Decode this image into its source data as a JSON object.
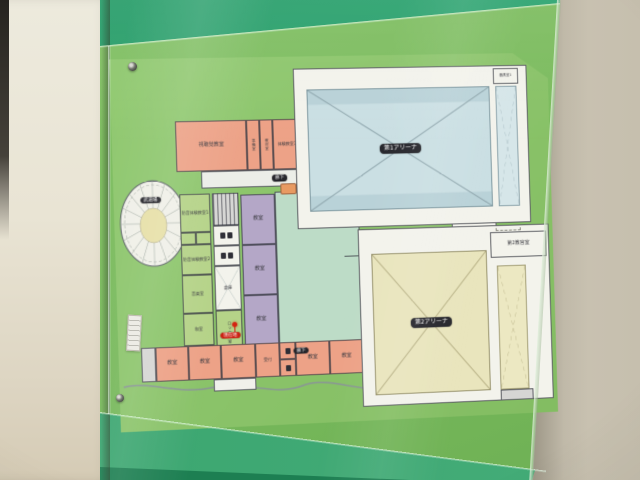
{
  "floor_plan": {
    "arena1": {
      "label": "第1アリーナ",
      "equipment_room": "器具室1"
    },
    "arena2": {
      "label": "第2アリーナ",
      "instructor_room": "第2教官室"
    },
    "round_hall": {
      "label": "武道場"
    },
    "upper_rooms": {
      "av_room": "視聴覚教室",
      "prep_room": "準備室",
      "material_room": "教材室",
      "experience_room_3": "体験教室3"
    },
    "west_rooms": {
      "soundproof_1": "防音体験教室1",
      "soundproof_2": "防音体験教室2",
      "music_room": "音楽室",
      "japanese_room": "和室"
    },
    "core_rooms": {
      "stairs": "階段",
      "storage": "倉庫",
      "locker_room": "ロッカー室"
    },
    "entrance": {
      "reception": "受付",
      "you_are_here": "現在地"
    },
    "labels": {
      "classroom": "教室",
      "corridor": "廊下"
    }
  },
  "colors": {
    "sign_green": "#7cbc5f",
    "sign_top_band": "#2b9e6b",
    "map_grass": "#8ac369",
    "arena1_floor": "#cadfe3",
    "arena2_floor": "#e9e5bd",
    "classroom_orange": "#eda287",
    "room_green": "#b5d388",
    "room_purple": "#b4a7c7",
    "plaza_teal": "#bddcc7",
    "marker_red": "#cc2214"
  }
}
